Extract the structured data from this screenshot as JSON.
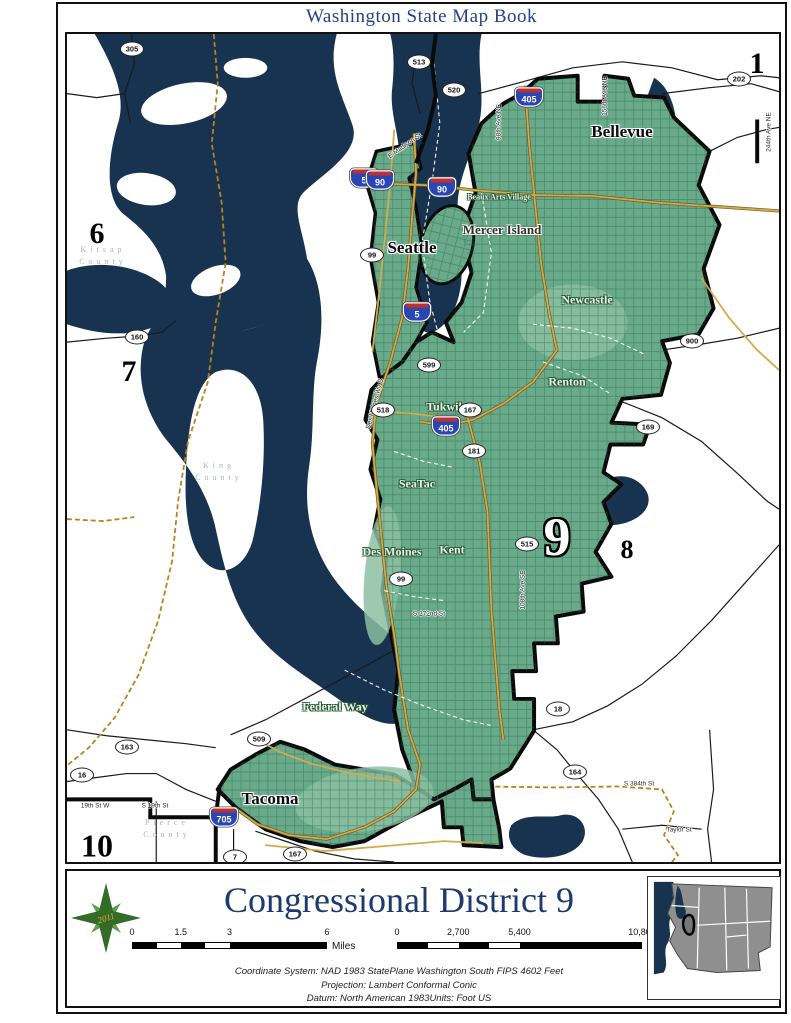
{
  "page": {
    "title": "Washington State Map Book"
  },
  "legend": {
    "title": "Congressional District 9",
    "year": "2011",
    "miles_scale": {
      "ticks": [
        "0",
        "1.5",
        "3",
        "6"
      ],
      "unit": "Miles"
    },
    "meters_scale": {
      "ticks": [
        "0",
        "2,700",
        "5,400",
        "10,800"
      ],
      "unit": "Meters"
    },
    "coordinate_system": "Coordinate System: NAD 1983 StatePlane Washington South FIPS 4602 Feet",
    "projection": "Projection: Lambert Conformal Conic",
    "datum": "Datum: North American 1983Units: Foot US"
  },
  "map": {
    "colors": {
      "water": "#17334f",
      "district_green": "#69aa8b",
      "district_green_light": "#8cc0a2",
      "road_yellow": "#d2ab4a",
      "county_line_orange": "#b8821e",
      "title_blue": "#24418a"
    },
    "district_numbers": [
      {
        "label": "1",
        "x": 690,
        "y": 30,
        "size": 30
      },
      {
        "label": "6",
        "x": 30,
        "y": 200,
        "size": 30
      },
      {
        "label": "7",
        "x": 62,
        "y": 338,
        "size": 30
      },
      {
        "label": "8",
        "x": 560,
        "y": 516,
        "size": 26
      },
      {
        "label": "9",
        "x": 490,
        "y": 503,
        "size": 54,
        "outline": true
      },
      {
        "label": "10",
        "x": 30,
        "y": 812,
        "size": 32
      }
    ],
    "cities_major": [
      {
        "name": "Seattle",
        "x": 345,
        "y": 214
      },
      {
        "name": "Bellevue",
        "x": 555,
        "y": 98
      },
      {
        "name": "Tacoma",
        "x": 203,
        "y": 765
      }
    ],
    "cities_mid": [
      {
        "name": "Mercer Island",
        "x": 435,
        "y": 196
      }
    ],
    "cities_minor": [
      {
        "name": "Newcastle",
        "x": 520,
        "y": 266
      },
      {
        "name": "Renton",
        "x": 500,
        "y": 348
      },
      {
        "name": "Tukwila",
        "x": 380,
        "y": 373
      },
      {
        "name": "SeaTac",
        "x": 350,
        "y": 450
      },
      {
        "name": "Kent",
        "x": 385,
        "y": 516
      },
      {
        "name": "Des Moines",
        "x": 325,
        "y": 518
      },
      {
        "name": "Federal Way",
        "x": 268,
        "y": 673
      },
      {
        "name": "Beaux Arts Village",
        "x": 432,
        "y": 163,
        "size": 8
      }
    ],
    "counties": [
      {
        "name": "Kitsap County",
        "x": 36,
        "y": 222
      },
      {
        "name": "King County",
        "x": 152,
        "y": 438
      },
      {
        "name": "Pierce County",
        "x": 100,
        "y": 795
      }
    ],
    "interstate_shields": [
      {
        "num": "405",
        "x": 462,
        "y": 63
      },
      {
        "num": "5",
        "x": 297,
        "y": 144
      },
      {
        "num": "90",
        "x": 313,
        "y": 146
      },
      {
        "num": "90",
        "x": 375,
        "y": 153
      },
      {
        "num": "5",
        "x": 350,
        "y": 278
      },
      {
        "num": "405",
        "x": 379,
        "y": 392
      },
      {
        "num": "705",
        "x": 157,
        "y": 783
      }
    ],
    "state_shields": [
      {
        "num": "305",
        "x": 65,
        "y": 15
      },
      {
        "num": "513",
        "x": 352,
        "y": 28
      },
      {
        "num": "520",
        "x": 387,
        "y": 56
      },
      {
        "num": "202",
        "x": 672,
        "y": 45
      },
      {
        "num": "99",
        "x": 305,
        "y": 221
      },
      {
        "num": "160",
        "x": 70,
        "y": 303
      },
      {
        "num": "599",
        "x": 362,
        "y": 331
      },
      {
        "num": "518",
        "x": 316,
        "y": 376
      },
      {
        "num": "167",
        "x": 403,
        "y": 376
      },
      {
        "num": "181",
        "x": 407,
        "y": 417
      },
      {
        "num": "900",
        "x": 625,
        "y": 307
      },
      {
        "num": "169",
        "x": 581,
        "y": 393
      },
      {
        "num": "515",
        "x": 460,
        "y": 510
      },
      {
        "num": "99",
        "x": 334,
        "y": 545
      },
      {
        "num": "18",
        "x": 491,
        "y": 675
      },
      {
        "num": "509",
        "x": 192,
        "y": 705
      },
      {
        "num": "163",
        "x": 60,
        "y": 713
      },
      {
        "num": "16",
        "x": 15,
        "y": 741
      },
      {
        "num": "164",
        "x": 508,
        "y": 738
      },
      {
        "num": "7",
        "x": 168,
        "y": 823
      },
      {
        "num": "167",
        "x": 228,
        "y": 820
      }
    ],
    "street_labels": [
      {
        "name": "E Madison St",
        "x": 338,
        "y": 112,
        "rot": -35
      },
      {
        "name": "98th Ave NE",
        "x": 432,
        "y": 88,
        "rot": -90
      },
      {
        "name": "156th Ave NE",
        "x": 538,
        "y": 62,
        "rot": -90
      },
      {
        "name": "244th Ave NE",
        "x": 702,
        "y": 98,
        "rot": -90
      },
      {
        "name": "Des Moines Wy S",
        "x": 308,
        "y": 370,
        "rot": -75
      },
      {
        "name": "S 272nd St",
        "x": 362,
        "y": 580,
        "rot": 0
      },
      {
        "name": "108th Ave SE",
        "x": 456,
        "y": 556,
        "rot": -90
      },
      {
        "name": "S 384th St",
        "x": 572,
        "y": 750,
        "rot": 0
      },
      {
        "name": "Taylor St",
        "x": 612,
        "y": 796,
        "rot": 0
      },
      {
        "name": "19th St W",
        "x": 28,
        "y": 772,
        "rot": 0
      },
      {
        "name": "S 19th St",
        "x": 88,
        "y": 772,
        "rot": 0
      }
    ]
  }
}
